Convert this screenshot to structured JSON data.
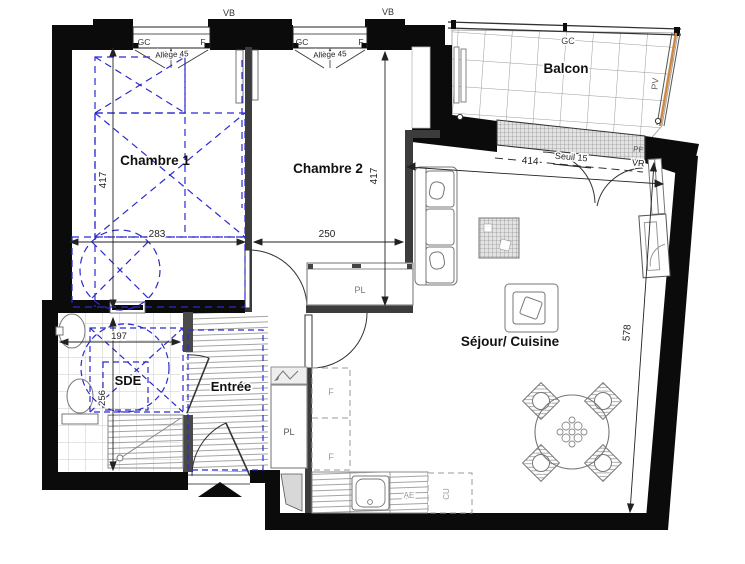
{
  "plan": {
    "rooms": {
      "chambre1": {
        "label": "Chambre 1"
      },
      "chambre2": {
        "label": "Chambre 2"
      },
      "sde": {
        "label": "SDE"
      },
      "entree": {
        "label": "Entrée"
      },
      "sejour_cuisine": {
        "label": "Séjour/ Cuisine"
      },
      "balcon": {
        "label": "Balcon"
      }
    },
    "dimensions_cm": {
      "chambre1_height": "417",
      "chambre1_width": "283",
      "chambre2_height": "417",
      "chambre2_width": "250",
      "sde_width": "197",
      "sde_height": "256",
      "sejour_width": "414",
      "sejour_height": "578"
    },
    "annotations": {
      "vb": "VB",
      "gc": "GC",
      "f": "F",
      "allege": "Allège 45",
      "pv": "PV",
      "pf": "PF",
      "seuil": "Seuil 15",
      "vr": "VR",
      "pl": "PL",
      "fridge": "F",
      "ae": "AE",
      "cu": "CU"
    },
    "legend_colors": {
      "wall_black": "#0b0b0b",
      "furniture_proposal_blue": "#2b2bd0",
      "wood_rail_orange": "#cc8a45",
      "fixture_gray": "#777777"
    }
  }
}
